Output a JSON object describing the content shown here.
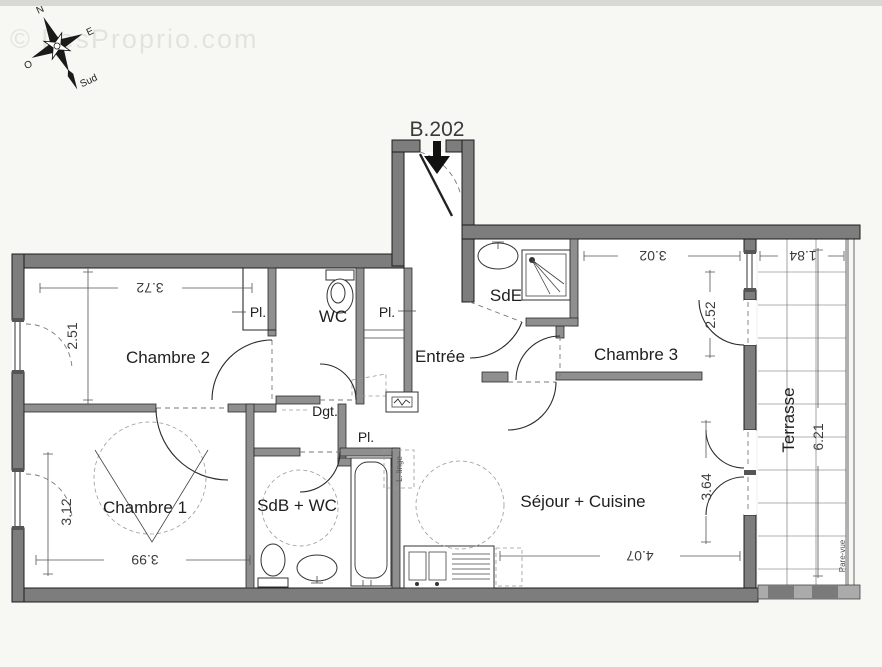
{
  "plan": {
    "unit_label": "B.202",
    "watermark": "© LesProprio.com",
    "compass": {
      "north": "N",
      "east": "E",
      "west": "O",
      "south": "Sud"
    },
    "rooms": {
      "chambre1": {
        "label": "Chambre 1",
        "width_m": "3.99",
        "depth_m": "3.12"
      },
      "chambre2": {
        "label": "Chambre 2",
        "width_m": "3.72",
        "depth_m": "2.51"
      },
      "chambre3": {
        "label": "Chambre 3",
        "width_m": "3.02",
        "depth_m": "2.52"
      },
      "sejour_cuisine": {
        "label": "Séjour + Cuisine",
        "width_m": "4.07",
        "depth_m": "3.64"
      },
      "terrasse": {
        "label": "Terrasse",
        "width_m": "1.84",
        "depth_m": "6.21"
      },
      "entree": {
        "label": "Entrée"
      },
      "wc": {
        "label": "WC"
      },
      "sde": {
        "label": "SdE"
      },
      "sdb_wc": {
        "label": "SdB + WC"
      },
      "degagement": {
        "label": "Dgt."
      }
    },
    "closets": {
      "chambre2_pl": "Pl.",
      "entree_pl": "Pl.",
      "degagement_pl": "Pl."
    },
    "annotations": {
      "lave_linge": "L. linge",
      "pare_vue": "Pare-vue"
    }
  }
}
